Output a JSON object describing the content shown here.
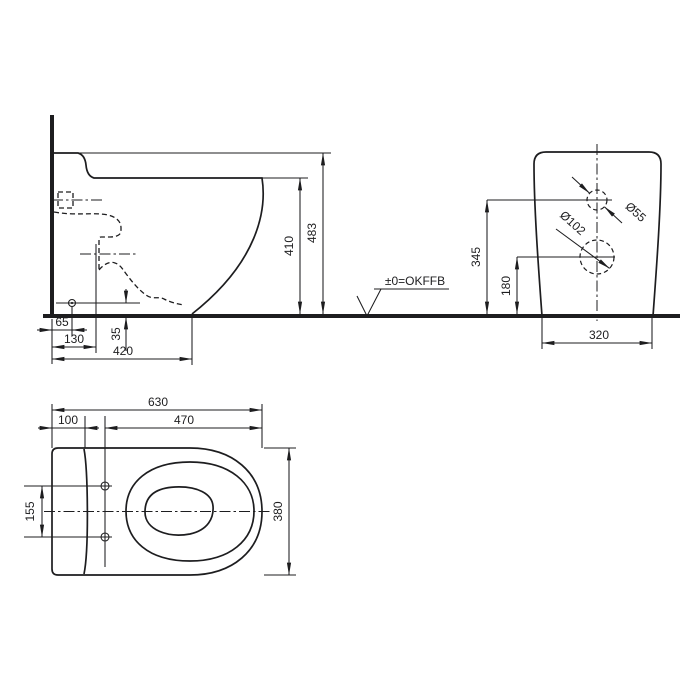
{
  "drawing": {
    "side_view": {
      "total_height": "483",
      "rim_height": "410",
      "outlet_wall_offset": "65",
      "trap_wall_offset": "130",
      "depth_to_front_base": "420",
      "outlet_height": "35",
      "floor_level_label": "±0=OKFFB"
    },
    "rear_view": {
      "supply_height": "345",
      "outlet_center_height": "180",
      "base_width": "320",
      "supply_diameter": "Ø55",
      "outlet_diameter": "Ø102"
    },
    "plan_view": {
      "total_length": "630",
      "rear_section_depth": "100",
      "bolt_to_front": "470",
      "bolt_hole_spacing": "155",
      "total_width": "380"
    },
    "colors": {
      "line": "#1d1d1f",
      "background": "#ffffff"
    }
  }
}
